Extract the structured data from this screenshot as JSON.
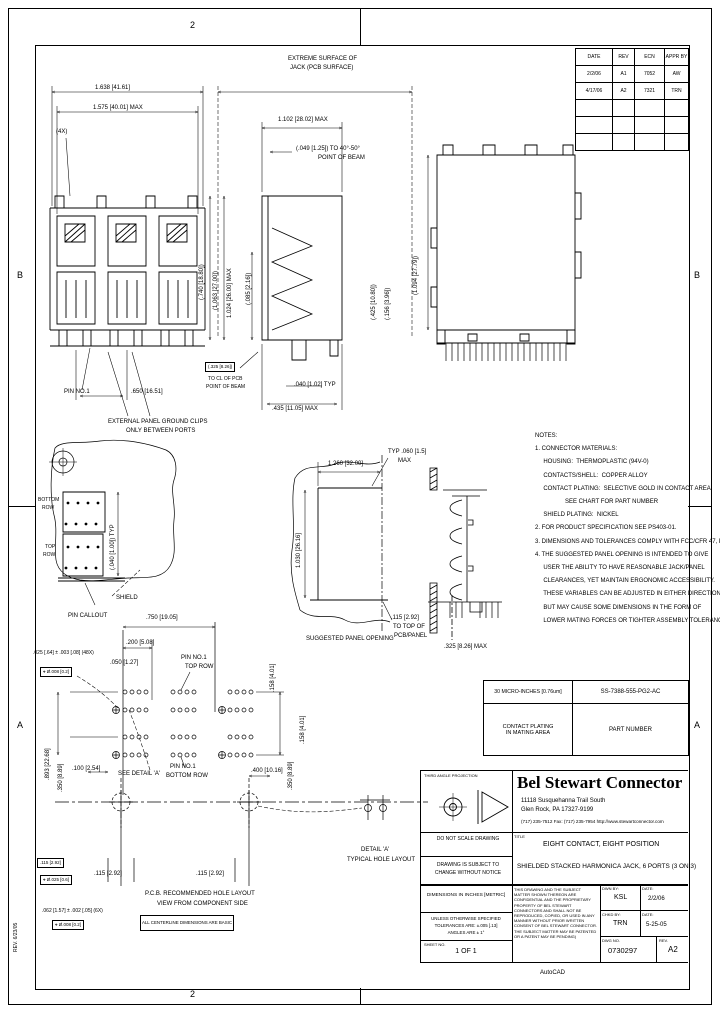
{
  "zones": {
    "top": "2",
    "bottom": "2",
    "left_upper": "B",
    "left_lower": "A",
    "right_upper": "B",
    "right_lower": "A",
    "margin_note": "REV. 6/23/05"
  },
  "rev_table": {
    "headers": [
      "DATE",
      "REV",
      "ECN",
      "APPR BY"
    ],
    "rows": [
      [
        "2/2/06",
        "A1",
        "7052",
        "AW"
      ],
      [
        "4/17/06",
        "A2",
        "7321",
        "TRN"
      ]
    ]
  },
  "part_table": {
    "plating": "30 MICRO-INCHES [0.76um]",
    "part_number": "SS-7388-555-PG2-AC",
    "plating_label1": "CONTACT PLATING",
    "plating_label2": "IN MATING AREA",
    "part_number_label": "PART NUMBER"
  },
  "notes": {
    "text": "NOTES:\n1. CONNECTOR MATERIALS:\n     HOUSING:  THERMOPLASTIC (94V-0)\n     CONTACTS/SHELL:  COPPER ALLOY\n     CONTACT PLATING:  SELECTIVE GOLD IN CONTACT AREA\n                  SEE CHART FOR PART NUMBER\n     SHIELD PLATING:  NICKEL\n2. FOR PRODUCT SPECIFICATION SEE PS403-01.\n3. DIMENSIONS AND TOLERANCES COMPLY WITH FCC/CFR 47, PART 68.\n4. THE SUGGESTED PANEL OPENING IS INTENDED TO GIVE\n     USER THE ABILITY TO HAVE REASONABLE JACK/PANEL\n     CLEARANCES, YET MAINTAIN ERGONOMIC ACCESSIBILITY.\n     THESE VARIABLES CAN BE ADJUSTED IN EITHER DIRECTION\n     BUT MAY CAUSE SOME DIMENSIONS IN THE FORM OF\n     LOWER MATING FORCES OR TIGHTER ASSEMBLY TOLERANCES."
  },
  "labels": {
    "t_width1": "1.638 [41.61]",
    "t_width2": "1.575 [40.01] MAX",
    "posts_4x": "(4X)",
    "surf1": "EXTREME SURFACE OF",
    "surf2": "JACK (PCB SURFACE)",
    "mid_width": "1.102 [28.02] MAX",
    "beam1": "(.049 [1.25]) TO 40°-50°",
    "beam2": "POINT OF BEAM",
    "sec_740": "(.740 [18.80])",
    "sec_1063": "(1.063 [27.00])",
    "sec_1024": "1.024 [26.00] MAX",
    "sec_085": "(.085 [2.16])",
    "rear_1094": "(1.094 [27.79])",
    "rear_425": "(.425 [10.80])",
    "rear_156": "(.156 [3.96])",
    "pin_no1": "PIN NO.1",
    "pitch_650": ".650 [16.51]",
    "gclip1": "EXTERNAL PANEL GROUND CLIPS",
    "gclip2": "ONLY BETWEEN PORTS",
    "basic_325": "(.325 [8.26])",
    "to_cl": "TO CL OF PCB",
    "beam3": "POINT OF BEAM",
    "typ_040": ".040 [1.02] TYP",
    "max_435": ".435 [11.05] MAX",
    "row_bottom1": "BOTTOM",
    "row_bottom2": "ROW",
    "row_top1": "TOP",
    "row_top2": "ROW",
    "typ_040b": "(.040 [1.00]) TYP",
    "pin_callout": "PIN CALLOUT",
    "shield": "SHIELD",
    "panel_w": "1.260 [32.00]",
    "panel_h": "1.030 [26.16]",
    "panel_typ1": "TYP .060 [1.5]",
    "panel_typ2": "MAX",
    "panel_115a": ".115 [2.92]",
    "panel_115b": "TO TOP OF",
    "panel_115c": "PCB/PANEL",
    "panel_label": "SUGGESTED PANEL OPENING",
    "shield_max": ".325 [8.26] MAX",
    "pcb_750": ".750 [19.05]",
    "pcb_200": ".200 [5.08]",
    "pcb_050": ".050 [1.27]",
    "pcb_pin1a1": "PIN NO.1",
    "pcb_pin1a2": "TOP ROW",
    "pcb_158": ".158 [4.01]",
    "tol_48x": ".025 [.64] ± .003 [.08] (48X)",
    "pos_008": "⌖ Ø.008 [0.2]",
    "pcb_893": ".893 [22.68]",
    "pcb_350l": ".350 [8.89]",
    "pcb_100": ".100 [2.54]",
    "see_detail": "SEE DETAIL 'A'",
    "pcb_pin1b1": "PIN NO.1",
    "pcb_pin1b2": "BOTTOM ROW",
    "pcb_400": ".400 [10.16]",
    "pcb_350r": ".350 [8.89]",
    "pcb_158r": ".158 [4.01]",
    "pcb_115a": ".115 [2.92]",
    "pcb_115b": ".115 [2.92]",
    "basic_115": ".115 [2.92]",
    "pos_025": "⌖ Ø.025 [0.6]",
    "tol_6x": ".062 [1.57] ± .002 [.05] (6X)",
    "pos_008b": "⌖ Ø.008 [0.2]",
    "pcb_title1": "P.C.B. RECOMMENDED HOLE LAYOUT",
    "pcb_title2": "VIEW FROM COMPONENT SIDE",
    "basic_note": "ALL CENTERLINE DIMENSIONS ARE BASIC",
    "detail_a1": "DETAIL 'A'",
    "detail_a2": "TYPICAL HOLE LAYOUT"
  },
  "title_block": {
    "third_angle": "THIRD ANGLE PROJECTION",
    "company": "Bel Stewart Connector",
    "address1": "11118 Susquehanna Trail South",
    "address2": "Glen Rock, PA  17327-9199",
    "address3": "(717) 235-7512   Fax: (717) 235-7954    http://www.stewartconnector.com",
    "do_not_scale": "DO NOT SCALE DRAWING",
    "change1": "DRAWING IS SUBJECT TO",
    "change2": "CHANGE WITHOUT NOTICE",
    "units": "DIMENSIONS IN INCHES [METRIC]",
    "tolerance1": "UNLESS OTHERWISE SPECIFIED",
    "tolerance2": "TOLERANCES ARE: ±.005 [.13]",
    "tolerance3": "ANGLES ARE ± 1°",
    "sheet_label": "SHEET NO.",
    "sheet": "1 OF 1",
    "title_label": "TITLE",
    "title_line1": "EIGHT CONTACT, EIGHT POSITION",
    "title_line2": "SHIELDED STACKED HARMONICA JACK, 6 PORTS (3 ON 3)",
    "proprietary": "THIS DRAWING AND THE SUBJECT MATTER SHOWN THEREON ARE CONFIDENTIAL AND THE PROPRIETARY PROPERTY OF BEL STEWART CONNECTORS AND SHALL NOT BE REPRODUCED, COPIED, OR USED IN ANY MANNER WITHOUT PRIOR WRITTEN CONSENT OF BEL STEWART CONNECTOR. THE SUBJECT MATTER MAY BE PATENTED OR A PATENT MAY BE PENDING)",
    "drawn_label": "DWN BY:",
    "drawn_by": "KSL",
    "date_label": "DATE:",
    "drawn_date": "2/2/06",
    "checked_label": "CHKD BY:",
    "checked_by": "TRN",
    "checked_date": "5-25-05",
    "dwg_no_label": "DWG NO.",
    "dwg_no": "0730297",
    "rev_label": "REV.",
    "rev": "A2",
    "cad_note": "AutoCAD"
  }
}
